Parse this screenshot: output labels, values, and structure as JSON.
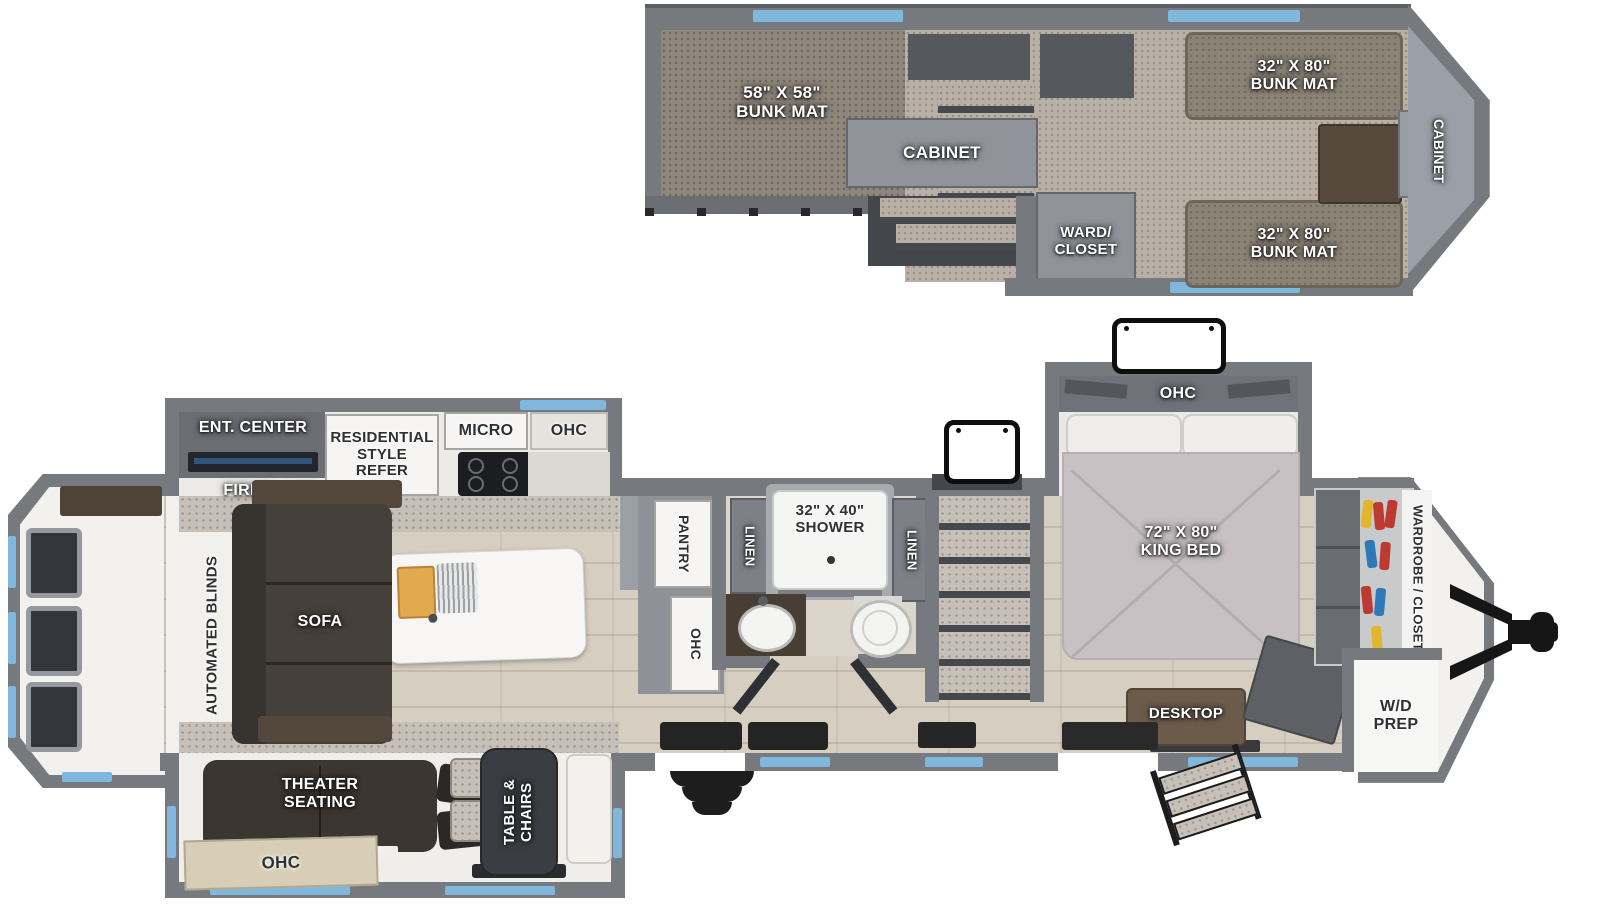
{
  "loft": {
    "bunk_mat_left": "58\" X 58\"\nBUNK MAT",
    "cabinet": "CABINET",
    "ward_closet": "WARD/\nCLOSET",
    "bunk_mat_top": "32\" X 80\"\nBUNK MAT",
    "bunk_mat_bottom": "32\" X 80\"\nBUNK MAT",
    "front_cabinet": "CABINET"
  },
  "living": {
    "automated_blinds": "AUTOMATED BLINDS",
    "sofa": "SOFA",
    "ent_center": "ENT. CENTER",
    "fireplace": "FIREPLACE",
    "theater_seating": "THEATER\nSEATING",
    "ohc_theater": "OHC",
    "table_chairs": "TABLE &\nCHAIRS"
  },
  "kitchen": {
    "refer": "RESIDENTIAL\nSTYLE\nREFER",
    "micro": "MICRO",
    "ohc": "OHC",
    "pantry": "PANTRY",
    "ohc_pantry": "OHC"
  },
  "bath": {
    "linen_left": "LINEN",
    "shower": "32\" X 40\"\nSHOWER",
    "linen_right": "LINEN"
  },
  "bedroom": {
    "ohc": "OHC",
    "king_bed": "72\" X 80\"\nKING BED",
    "wardrobe_closet": "WARDROBE / CLOSET",
    "wd_prep": "W/D\nPREP",
    "desktop": "DESKTOP"
  },
  "colors": {
    "wall": "#76797e",
    "window_blue": "#80b7dc",
    "floor_wood": "#d6cec1",
    "carpet_light": "#b9b1a6",
    "carpet_dark": "#8f877c",
    "furniture_dark": "#45403a",
    "hanger_yellow": "#e2b62c",
    "hanger_red": "#bd3a31",
    "hanger_blue": "#2f79b8"
  }
}
